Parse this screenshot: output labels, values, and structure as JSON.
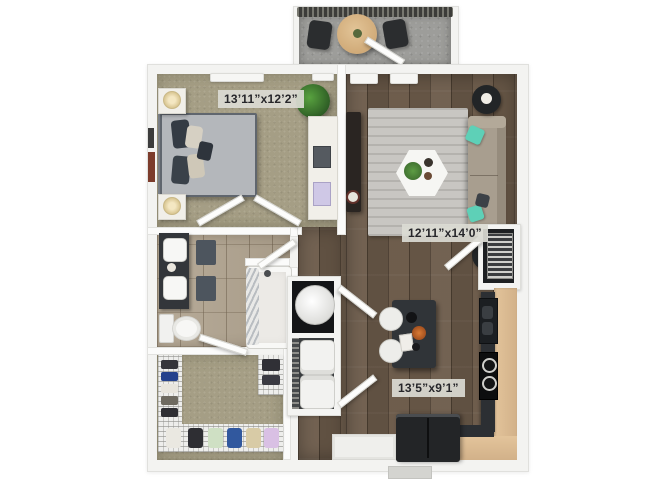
{
  "plan": {
    "title": "One-bedroom apartment 3D floor plan",
    "rooms": {
      "bedroom": {
        "name": "bedroom",
        "dimensions": "13’11”x12’2”"
      },
      "living": {
        "name": "living-room",
        "dimensions": "12’11”x14’0”"
      },
      "kitchen": {
        "name": "kitchen-dining",
        "dimensions": "13’5”x9’1”"
      },
      "bathroom": {
        "name": "bathroom"
      },
      "closet": {
        "name": "walk-in-closet"
      },
      "balcony": {
        "name": "balcony"
      },
      "utility": {
        "name": "utility-closets"
      }
    },
    "furniture": {
      "bedroom": [
        "bed",
        "nightstand-top",
        "nightstand-bottom",
        "table-lamps",
        "desk",
        "potted-plant",
        "wall-art",
        "ceiling-lights"
      ],
      "living": [
        "sofa",
        "teal-accent-pillows",
        "round-side-table-top",
        "round-side-table-bottom",
        "hexagon-coffee-table",
        "coffee-table-plant",
        "area-rug",
        "media-console"
      ],
      "kitchen": [
        "l-shaped-counter",
        "sink",
        "cooktop",
        "refrigerator",
        "island-dining-table",
        "two-stools",
        "entry-cabinet"
      ],
      "bathroom": [
        "double-sink-vanity",
        "bath-mats",
        "toilet",
        "bathtub-shower",
        "shower-curtain"
      ],
      "closet": [
        "wire-shelving",
        "shoes",
        "hanging-clothes"
      ],
      "utility": [
        "water-heater",
        "stacked-washer-dryer",
        "hvac-unit"
      ],
      "balcony": [
        "railing",
        "bistro-table",
        "patio-chairs"
      ]
    },
    "colors": {
      "carpet": "#a59e85",
      "wood_floor": "#6b5a49",
      "tile_floor": "#b2a591",
      "concrete": "#9d9d9a",
      "wall": "#fbfbfa",
      "counter_top": "#dcbd94",
      "dark_cabinetry": "#2c2f33",
      "sofa": "#a89e8f",
      "accent_teal": "#5ed0b7",
      "rug": "#c8c6c2",
      "plant_green": "#3f7c33",
      "label_bg": "#dbdbd4",
      "label_text": "#26262a"
    }
  }
}
